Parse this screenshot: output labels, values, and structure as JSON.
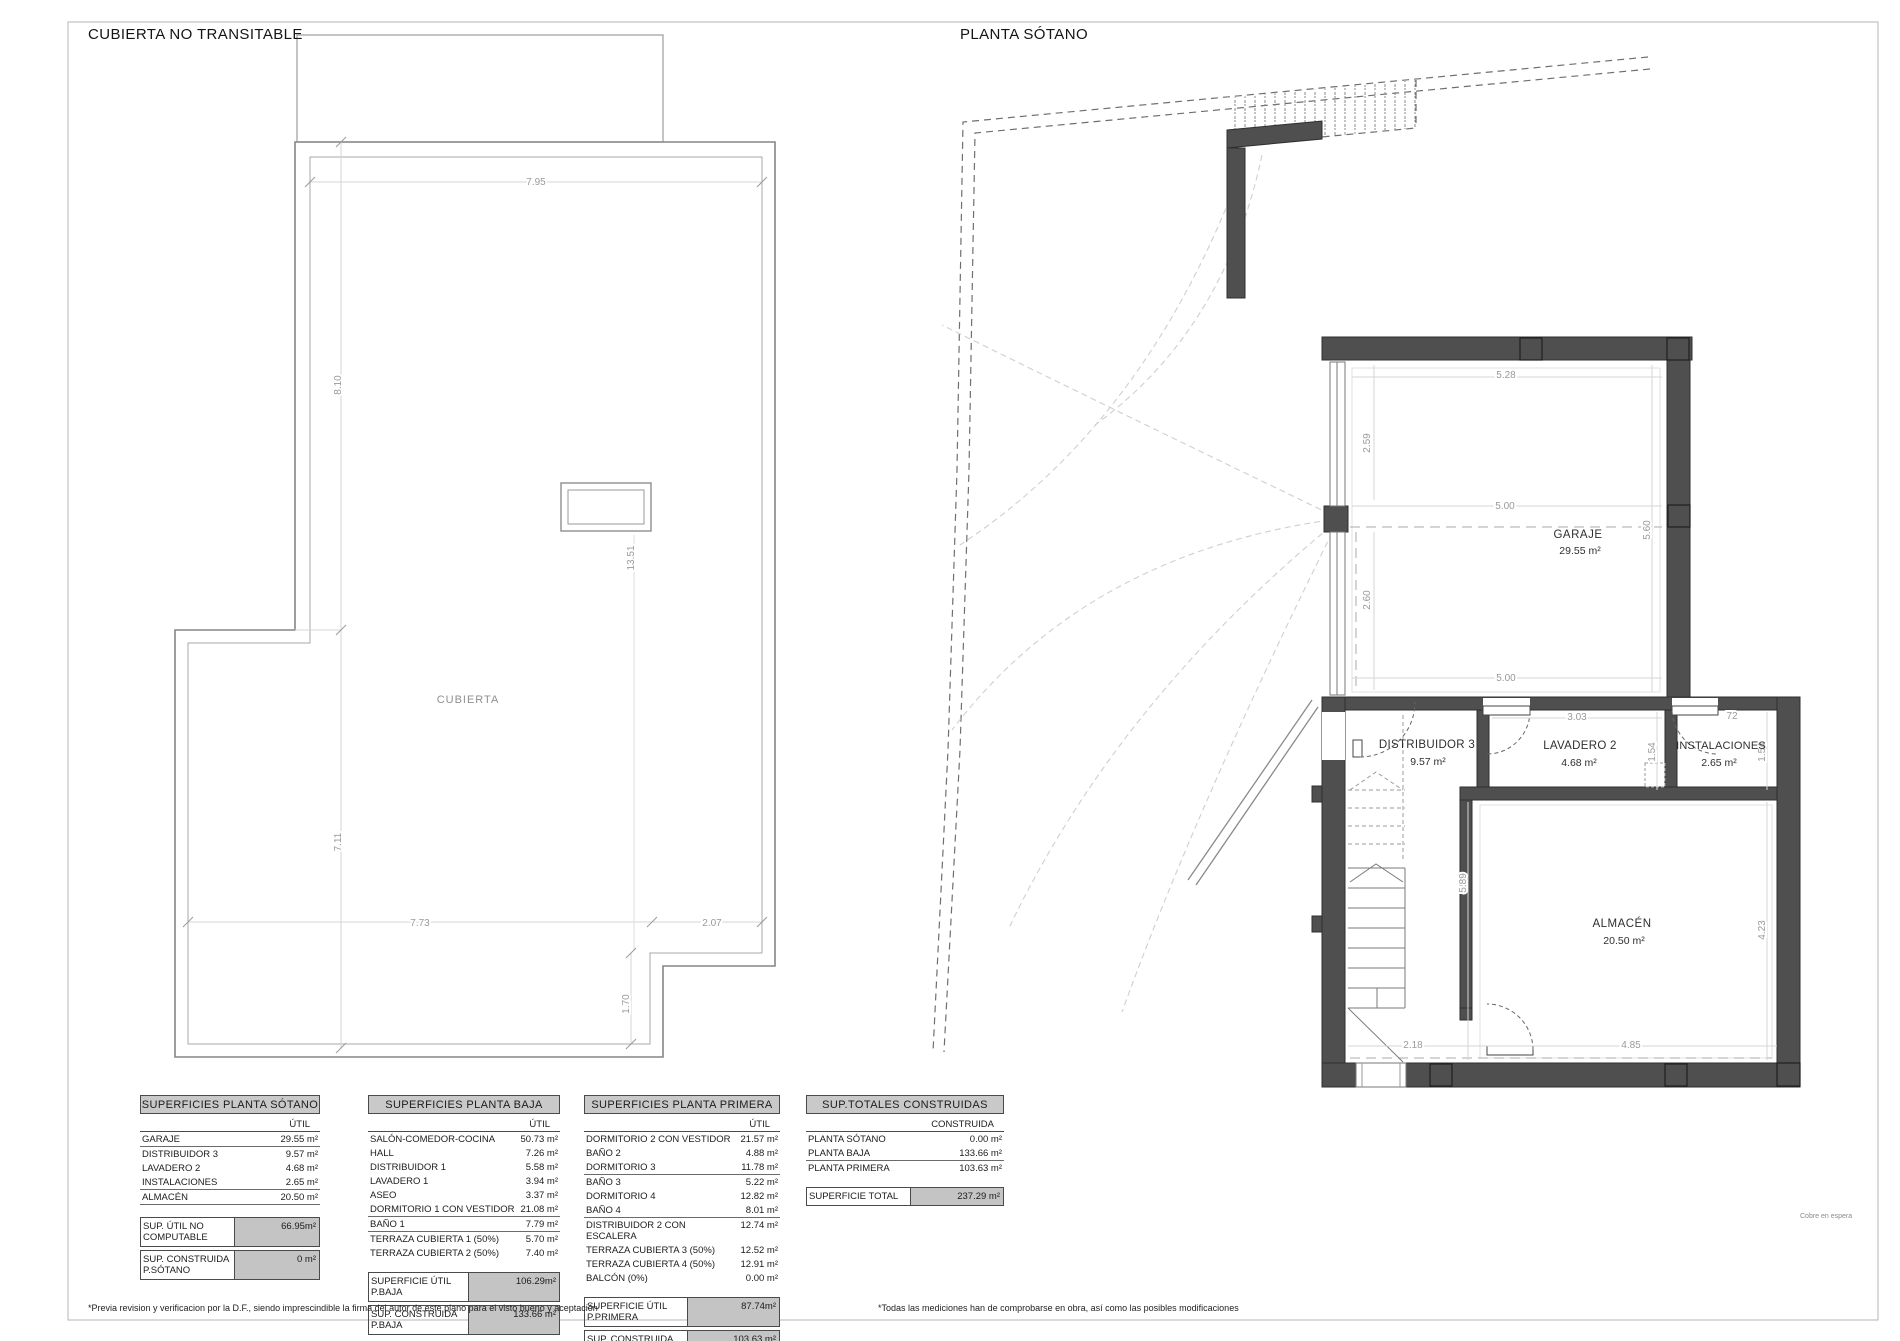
{
  "page": {
    "left_title": "CUBIERTA NO TRANSITABLE",
    "right_title": "PLANTA SÓTANO",
    "footnote_left": "*Previa revision y verificacion por la D.F., siendo imprescindible la firma del autor de este plano para el visto bueno y aceptación",
    "footnote_right": "*Todas las mediciones han de comprobarse en obra, así como las posibles modificaciones",
    "side_note": "Cobre en espera"
  },
  "roof": {
    "room_label": "CUBIERTA",
    "dims": {
      "top": "7.95",
      "left_upper": "8.10",
      "left_lower": "7.11",
      "center": "13.51",
      "bottom_left": "7.73",
      "bottom_right": "2.07",
      "notch": "1.70"
    }
  },
  "basement": {
    "rooms": {
      "garaje": {
        "name": "GARAJE",
        "area": "29.55 m²"
      },
      "distribuidor": {
        "name": "DISTRIBUIDOR 3",
        "area": "9.57 m²"
      },
      "lavadero": {
        "name": "LAVADERO 2",
        "area": "4.68 m²"
      },
      "instalaciones": {
        "name": "INSTALACIONES",
        "area": "2.65 m²"
      },
      "almacen": {
        "name": "ALMACÉN",
        "area": "20.50 m²"
      }
    },
    "dims": {
      "garage_top": "5.28",
      "garage_upper_left": "2.59",
      "garage_mid": "5.00",
      "garage_lower_left": "2.60",
      "garage_bottom": "5.00",
      "garage_right": "5.60",
      "lavadero_top": "3.03",
      "lavadero_right": "1.54",
      "instalaciones_right": "1.54",
      "almacen_left": "5.89",
      "almacen_right": "4.23",
      "bottom_left": "2.18",
      "almacen_bottom": "4.85",
      "top_right": "72"
    }
  },
  "tables": {
    "sotano": {
      "title": "SUPERFICIES PLANTA SÓTANO",
      "col": "ÚTIL",
      "rows": [
        {
          "label": "GARAJE",
          "value": "29.55 m²"
        },
        {
          "label": "DISTRIBUIDOR 3",
          "value": "9.57 m²"
        },
        {
          "label": "LAVADERO 2",
          "value": "4.68 m²"
        },
        {
          "label": "INSTALACIONES",
          "value": "2.65 m²"
        },
        {
          "label": "ALMACÉN",
          "value": "20.50 m²"
        }
      ],
      "totals": [
        {
          "label": "SUP. ÚTIL NO COMPUTABLE",
          "value": "66.95m²"
        },
        {
          "label": "SUP. CONSTRUIDA P.SÓTANO",
          "value": "0 m²"
        }
      ]
    },
    "baja": {
      "title": "SUPERFICIES PLANTA BAJA",
      "col": "ÚTIL",
      "rows": [
        {
          "label": "SALÓN-COMEDOR-COCINA",
          "value": "50.73 m²"
        },
        {
          "label": "HALL",
          "value": "7.26 m²"
        },
        {
          "label": "DISTRIBUIDOR 1",
          "value": "5.58 m²"
        },
        {
          "label": "LAVADERO 1",
          "value": "3.94 m²"
        },
        {
          "label": "ASEO",
          "value": "3.37 m²"
        },
        {
          "label": "DORMITORIO 1 CON VESTIDOR",
          "value": "21.08 m²"
        },
        {
          "label": "BAÑO 1",
          "value": "7.79 m²"
        },
        {
          "label": "TERRAZA CUBIERTA 1 (50%)",
          "value": "5.70 m²"
        },
        {
          "label": "TERRAZA CUBIERTA 2 (50%)",
          "value": "7.40 m²"
        }
      ],
      "totals": [
        {
          "label": "SUPERFICIE ÚTIL P.BAJA",
          "value": "106.29m²"
        },
        {
          "label": "SUP. CONSTRUIDA P.BAJA",
          "value": "133.66 m²"
        }
      ]
    },
    "primera": {
      "title": "SUPERFICIES PLANTA PRIMERA",
      "col": "ÚTIL",
      "rows": [
        {
          "label": "DORMITORIO 2 CON VESTIDOR",
          "value": "21.57 m²"
        },
        {
          "label": "BAÑO 2",
          "value": "4.88 m²"
        },
        {
          "label": "DORMITORIO 3",
          "value": "11.78 m²"
        },
        {
          "label": "BAÑO 3",
          "value": "5.22 m²"
        },
        {
          "label": "DORMITORIO 4",
          "value": "12.82 m²"
        },
        {
          "label": "BAÑO 4",
          "value": "8.01 m²"
        },
        {
          "label": "DISTRIBUIDOR 2 CON ESCALERA",
          "value": "12.74 m²"
        },
        {
          "label": "TERRAZA CUBIERTA 3 (50%)",
          "value": "12.52 m²"
        },
        {
          "label": "TERRAZA CUBIERTA 4 (50%)",
          "value": "12.91 m²"
        },
        {
          "label": "BALCÓN (0%)",
          "value": "0.00 m²"
        }
      ],
      "totals": [
        {
          "label": "SUPERFICIE ÚTIL P.PRIMERA",
          "value": "87.74m²"
        },
        {
          "label": "SUP. CONSTRUIDA P.PRIMERA",
          "value": "103.63 m²"
        }
      ]
    },
    "totales": {
      "title": "SUP.TOTALES CONSTRUIDAS",
      "col": "CONSTRUIDA",
      "rows": [
        {
          "label": "PLANTA SÓTANO",
          "value": "0.00 m²"
        },
        {
          "label": "PLANTA BAJA",
          "value": "133.66 m²"
        },
        {
          "label": "PLANTA PRIMERA",
          "value": "103.63 m²"
        }
      ],
      "totals": [
        {
          "label": "SUPERFICIE TOTAL",
          "value": "237.29 m²"
        }
      ]
    }
  }
}
